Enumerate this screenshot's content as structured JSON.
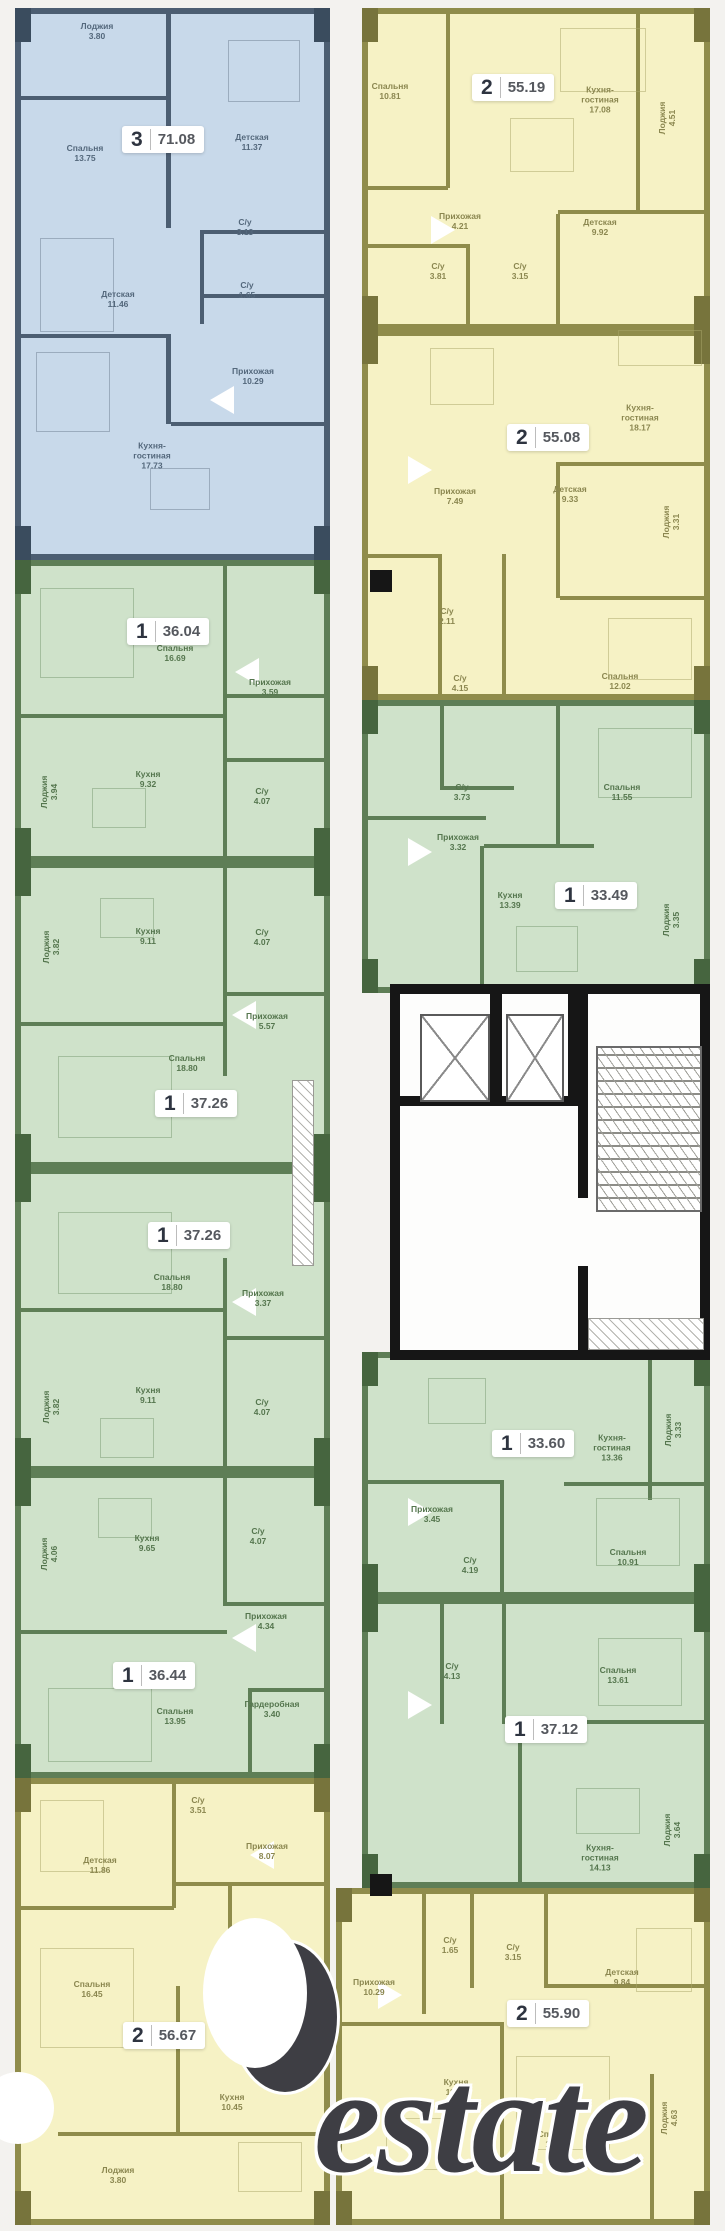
{
  "watermark": {
    "brand": "Restate",
    "visible_text": "estate"
  },
  "colors": {
    "blue_fill": "#c8d9ea",
    "blue_wall": "#4c5e72",
    "green_fill": "#cfe2ca",
    "green_wall": "#5e7e56",
    "yellow_fill": "#f6f2c5",
    "yellow_wall": "#8f8c4b",
    "core_wall": "#161616",
    "background": "#f3f2ef"
  },
  "apartments": [
    {
      "id": "apt-blue-71-08",
      "palette": "blue",
      "rooms_count": "3",
      "total_area": "71.08",
      "block": {
        "x": 15,
        "y": 8,
        "w": 315,
        "h": 552
      },
      "badge": {
        "x": 122,
        "y": 126
      },
      "rooms": [
        {
          "name": "Лоджия",
          "area": "3.80",
          "x": 97,
          "y": 32
        },
        {
          "name": "Детская",
          "area": "11.37",
          "x": 252,
          "y": 143
        },
        {
          "name": "Спальня",
          "area": "13.75",
          "x": 85,
          "y": 154
        },
        {
          "name": "С/у",
          "area": "3.13",
          "x": 245,
          "y": 228
        },
        {
          "name": "С/у",
          "area": "1.65",
          "x": 247,
          "y": 291
        },
        {
          "name": "Детская",
          "area": "11.46",
          "x": 118,
          "y": 300
        },
        {
          "name": "Прихожая",
          "area": "10.29",
          "x": 253,
          "y": 377
        },
        {
          "name": "Кухня-гостиная",
          "area": "17.73",
          "x": 152,
          "y": 456
        }
      ]
    },
    {
      "id": "apt-green-36-04",
      "palette": "green",
      "rooms_count": "1",
      "total_area": "36.04",
      "block": {
        "x": 15,
        "y": 560,
        "w": 315,
        "h": 302
      },
      "badge": {
        "x": 127,
        "y": 618
      },
      "rooms": [
        {
          "name": "Спальня",
          "area": "16.69",
          "x": 175,
          "y": 654
        },
        {
          "name": "Прихожая",
          "area": "3.59",
          "x": 270,
          "y": 688
        },
        {
          "name": "Кухня",
          "area": "9.32",
          "x": 148,
          "y": 780
        },
        {
          "name": "Лоджия",
          "area": "3.94",
          "x": 50,
          "y": 792,
          "vertical": true
        },
        {
          "name": "С/у",
          "area": "4.07",
          "x": 262,
          "y": 797
        }
      ]
    },
    {
      "id": "apt-green-37-26-a",
      "palette": "green",
      "rooms_count": "1",
      "total_area": "37.26",
      "block": {
        "x": 15,
        "y": 862,
        "w": 315,
        "h": 306
      },
      "badge": {
        "x": 155,
        "y": 1090
      },
      "rooms": [
        {
          "name": "Кухня",
          "area": "9.11",
          "x": 148,
          "y": 937
        },
        {
          "name": "С/у",
          "area": "4.07",
          "x": 262,
          "y": 938
        },
        {
          "name": "Лоджия",
          "area": "3.82",
          "x": 52,
          "y": 947,
          "vertical": true
        },
        {
          "name": "Прихожая",
          "area": "5.57",
          "x": 267,
          "y": 1022
        },
        {
          "name": "Спальня",
          "area": "18.80",
          "x": 187,
          "y": 1064
        }
      ]
    },
    {
      "id": "apt-green-37-26-b",
      "palette": "green",
      "rooms_count": "1",
      "total_area": "37.26",
      "block": {
        "x": 15,
        "y": 1168,
        "w": 315,
        "h": 304
      },
      "badge": {
        "x": 148,
        "y": 1222
      },
      "rooms": [
        {
          "name": "Спальня",
          "area": "18.80",
          "x": 172,
          "y": 1283
        },
        {
          "name": "Прихожая",
          "area": "3.37",
          "x": 263,
          "y": 1299
        },
        {
          "name": "Кухня",
          "area": "9.11",
          "x": 148,
          "y": 1396
        },
        {
          "name": "Лоджия",
          "area": "3.82",
          "x": 52,
          "y": 1407,
          "vertical": true
        },
        {
          "name": "С/у",
          "area": "4.07",
          "x": 262,
          "y": 1408
        }
      ]
    },
    {
      "id": "apt-green-36-44",
      "palette": "green",
      "rooms_count": "1",
      "total_area": "36.44",
      "block": {
        "x": 15,
        "y": 1472,
        "w": 315,
        "h": 306
      },
      "badge": {
        "x": 113,
        "y": 1662
      },
      "rooms": [
        {
          "name": "С/у",
          "area": "4.07",
          "x": 258,
          "y": 1537
        },
        {
          "name": "Кухня",
          "area": "9.65",
          "x": 147,
          "y": 1544
        },
        {
          "name": "Лоджия",
          "area": "4.06",
          "x": 50,
          "y": 1554,
          "vertical": true
        },
        {
          "name": "Прихожая",
          "area": "4.34",
          "x": 266,
          "y": 1622
        },
        {
          "name": "Гардеробная",
          "area": "3.40",
          "x": 272,
          "y": 1710
        },
        {
          "name": "Спальня",
          "area": "13.95",
          "x": 175,
          "y": 1717
        }
      ]
    },
    {
      "id": "apt-yellow-56-67",
      "palette": "yellow",
      "rooms_count": "2",
      "total_area": "56.67",
      "block": {
        "x": 15,
        "y": 1778,
        "w": 315,
        "h": 447
      },
      "badge": {
        "x": 123,
        "y": 2022
      },
      "rooms": [
        {
          "name": "С/у",
          "area": "3.51",
          "x": 198,
          "y": 1806
        },
        {
          "name": "Прихожая",
          "area": "8.07",
          "x": 267,
          "y": 1852
        },
        {
          "name": "Детская",
          "area": "11.86",
          "x": 100,
          "y": 1866
        },
        {
          "name": "С/у",
          "area": "4.63",
          "x": 246,
          "y": 1963
        },
        {
          "name": "Спальня",
          "area": "16.45",
          "x": 92,
          "y": 1990
        },
        {
          "name": "Кухня",
          "area": "10.45",
          "x": 232,
          "y": 2103
        },
        {
          "name": "Лоджия",
          "area": "3.80",
          "x": 118,
          "y": 2176
        }
      ]
    },
    {
      "id": "apt-yellow-55-19",
      "palette": "yellow",
      "rooms_count": "2",
      "total_area": "55.19",
      "block": {
        "x": 362,
        "y": 8,
        "w": 348,
        "h": 322
      },
      "badge": {
        "x": 472,
        "y": 74
      },
      "rooms": [
        {
          "name": "Спальня",
          "area": "10.81",
          "x": 390,
          "y": 92
        },
        {
          "name": "Кухня-гостиная",
          "area": "17.08",
          "x": 600,
          "y": 100
        },
        {
          "name": "Лоджия",
          "area": "4.51",
          "x": 668,
          "y": 118,
          "vertical": true
        },
        {
          "name": "Прихожая",
          "area": "4.21",
          "x": 460,
          "y": 222
        },
        {
          "name": "Детская",
          "area": "9.92",
          "x": 600,
          "y": 228
        },
        {
          "name": "С/у",
          "area": "3.81",
          "x": 438,
          "y": 272
        },
        {
          "name": "С/у",
          "area": "3.15",
          "x": 520,
          "y": 272
        }
      ]
    },
    {
      "id": "apt-yellow-55-08",
      "palette": "yellow",
      "rooms_count": "2",
      "total_area": "55.08",
      "block": {
        "x": 362,
        "y": 330,
        "w": 348,
        "h": 370
      },
      "badge": {
        "x": 507,
        "y": 424
      },
      "rooms": [
        {
          "name": "Кухня-гостиная",
          "area": "18.17",
          "x": 640,
          "y": 418
        },
        {
          "name": "Прихожая",
          "area": "7.49",
          "x": 455,
          "y": 497
        },
        {
          "name": "Детская",
          "area": "9.33",
          "x": 570,
          "y": 495
        },
        {
          "name": "Лоджия",
          "area": "3.31",
          "x": 672,
          "y": 522,
          "vertical": true
        },
        {
          "name": "С/у",
          "area": "2.11",
          "x": 447,
          "y": 617
        },
        {
          "name": "С/у",
          "area": "4.15",
          "x": 460,
          "y": 684
        },
        {
          "name": "Спальня",
          "area": "12.02",
          "x": 620,
          "y": 682
        }
      ]
    },
    {
      "id": "apt-green-33-49",
      "palette": "green",
      "rooms_count": "1",
      "total_area": "33.49",
      "block": {
        "x": 362,
        "y": 700,
        "w": 348,
        "h": 293
      },
      "badge": {
        "x": 555,
        "y": 882
      },
      "rooms": [
        {
          "name": "С/у",
          "area": "3.73",
          "x": 462,
          "y": 793
        },
        {
          "name": "Спальня",
          "area": "11.55",
          "x": 622,
          "y": 793
        },
        {
          "name": "Прихожая",
          "area": "3.32",
          "x": 458,
          "y": 843
        },
        {
          "name": "Кухня",
          "area": "13.39",
          "x": 510,
          "y": 901
        },
        {
          "name": "Лоджия",
          "area": "3.35",
          "x": 672,
          "y": 920,
          "vertical": true
        }
      ]
    },
    {
      "id": "apt-green-33-60",
      "palette": "green",
      "rooms_count": "1",
      "total_area": "33.60",
      "block": {
        "x": 362,
        "y": 1352,
        "w": 348,
        "h": 246
      },
      "badge": {
        "x": 492,
        "y": 1430
      },
      "rooms": [
        {
          "name": "Кухня-гостиная",
          "area": "13.36",
          "x": 612,
          "y": 1448
        },
        {
          "name": "Лоджия",
          "area": "3.33",
          "x": 674,
          "y": 1430,
          "vertical": true
        },
        {
          "name": "Прихожая",
          "area": "3.45",
          "x": 432,
          "y": 1515
        },
        {
          "name": "С/у",
          "area": "4.19",
          "x": 470,
          "y": 1566
        },
        {
          "name": "Спальня",
          "area": "10.91",
          "x": 628,
          "y": 1558
        }
      ]
    },
    {
      "id": "apt-green-37-12",
      "palette": "green",
      "rooms_count": "1",
      "total_area": "37.12",
      "block": {
        "x": 362,
        "y": 1598,
        "w": 348,
        "h": 290
      },
      "badge": {
        "x": 505,
        "y": 1716
      },
      "rooms": [
        {
          "name": "С/у",
          "area": "4.13",
          "x": 452,
          "y": 1672
        },
        {
          "name": "Спальня",
          "area": "13.61",
          "x": 618,
          "y": 1676
        },
        {
          "name": "Кухня-гостиная",
          "area": "14.13",
          "x": 600,
          "y": 1858
        },
        {
          "name": "Лоджия",
          "area": "3.64",
          "x": 673,
          "y": 1830,
          "vertical": true
        }
      ]
    },
    {
      "id": "apt-yellow-55-90",
      "palette": "yellow",
      "rooms_count": "2",
      "total_area": "55.90",
      "block": {
        "x": 336,
        "y": 1888,
        "w": 374,
        "h": 337
      },
      "badge": {
        "x": 507,
        "y": 2000
      },
      "rooms": [
        {
          "name": "С/у",
          "area": "1.65",
          "x": 450,
          "y": 1946
        },
        {
          "name": "С/у",
          "area": "3.15",
          "x": 513,
          "y": 1953
        },
        {
          "name": "Детская",
          "area": "9.84",
          "x": 622,
          "y": 1978
        },
        {
          "name": "Прихожая",
          "area": "10.29",
          "x": 374,
          "y": 1988
        },
        {
          "name": "Кухня",
          "area": "11.20",
          "x": 456,
          "y": 2088
        },
        {
          "name": "Спальня",
          "area": "13.50",
          "x": 556,
          "y": 2140
        },
        {
          "name": "Лоджия",
          "area": "4.63",
          "x": 670,
          "y": 2118,
          "vertical": true
        }
      ]
    }
  ],
  "core": {
    "elevators": [
      "elevator-shaft-1",
      "elevator-shaft-2"
    ],
    "staircase": "staircase"
  }
}
